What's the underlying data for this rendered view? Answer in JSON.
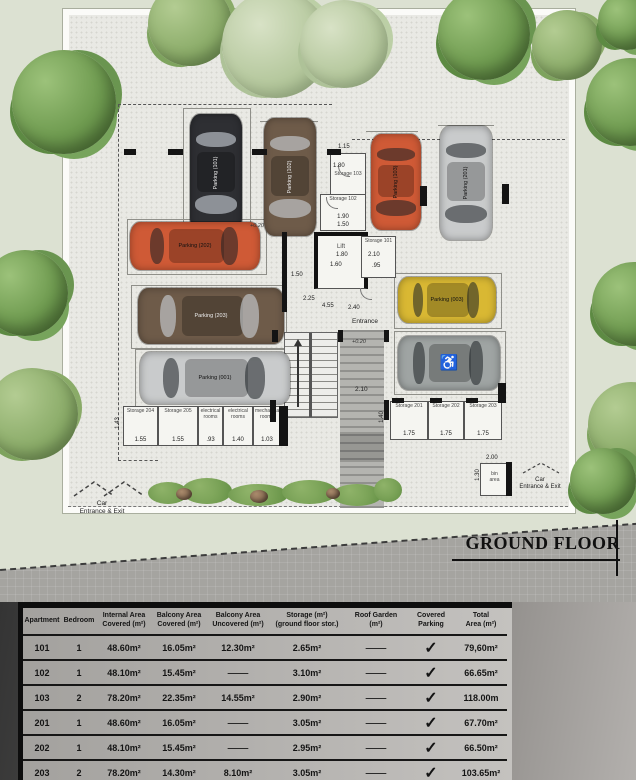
{
  "title": {
    "floor": "GROUND FLOOR"
  },
  "plan": {
    "parkings": [
      {
        "label": "Parking (101)",
        "color": "#2e2f33"
      },
      {
        "label": "Parking (102)",
        "color": "#6e5b49"
      },
      {
        "label": "Parking (103)",
        "color": "#cf5a36"
      },
      {
        "label": "Parking (201)",
        "color": "#c9cbcc"
      },
      {
        "label": "Parking (202)",
        "color": "#cf5a36"
      },
      {
        "label": "Parking (203)",
        "color": "#6e5b49"
      },
      {
        "label": "Parking (001)",
        "color": "#c9cbcc"
      },
      {
        "label": "Parking (003)",
        "color": "#d9b833"
      },
      {
        "label": "",
        "color": "#9fa4a3",
        "icon": "wheelchair"
      }
    ],
    "rooms": {
      "s103": {
        "label": "Storage 103"
      },
      "s102": {
        "label": "Storage 102"
      },
      "s101": {
        "label": "Storage 101"
      },
      "lift": {
        "label": "Lift"
      },
      "entrance": {
        "label": "Entrance"
      },
      "s201": {
        "label": "Storage 201"
      },
      "s202": {
        "label": "Storage 202"
      },
      "s203": {
        "label": "Storage 203"
      },
      "s204": {
        "label": "Storage 204"
      },
      "s205": {
        "label": "Storage 205"
      },
      "elec1": {
        "label": "electrical\nrooms"
      },
      "elec2": {
        "label": "electrical\nrooms"
      },
      "mech": {
        "label": "mechanical\nrooms"
      },
      "bin": {
        "label": "bin\narea"
      }
    },
    "dims": [
      "1.15",
      "1.80",
      "1.90",
      "1.50",
      "1.80",
      "1.60",
      "1.50",
      "2.10",
      ".95",
      "4.55",
      "2.40",
      "2.25",
      "+0.20",
      "+0.20",
      "2.10",
      "1.55",
      "1.55",
      ".93",
      "1.40",
      "1.03",
      "1.43",
      "1.75",
      "1.75",
      "1.75",
      "1.40",
      "2.00",
      "1.30"
    ],
    "entrances": {
      "left": "Car\nEntrance & Exit",
      "right": "Car\nEntrance & Exit"
    }
  },
  "table": {
    "columns": [
      "Apartment",
      "Bedroom",
      "Internal Area\nCovered (m²)",
      "Balcony Area\nCovered (m²)",
      "Balcony Area\nUncovered (m²)",
      "Storage (m²)\n(ground floor stor.)",
      "Roof Garden\n(m²)",
      "Covered\nParking",
      "Total\nArea (m²)"
    ],
    "rows": [
      [
        "101",
        "1",
        "48.60m²",
        "16.05m²",
        "12.30m²",
        "2.65m²",
        "—",
        "✓",
        "79,60m²"
      ],
      [
        "102",
        "1",
        "48.10m²",
        "15.45m²",
        "—",
        "3.10m²",
        "—",
        "✓",
        "66.65m²"
      ],
      [
        "103",
        "2",
        "78.20m²",
        "22.35m²",
        "14.55m²",
        "2.90m²",
        "—",
        "✓",
        "118.00m"
      ],
      [
        "201",
        "1",
        "48.60m²",
        "16.05m²",
        "—",
        "3.05m²",
        "—",
        "✓",
        "67.70m²"
      ],
      [
        "202",
        "1",
        "48.10m²",
        "15.45m²",
        "—",
        "2.95m²",
        "—",
        "✓",
        "66.50m²"
      ],
      [
        "203",
        "2",
        "78.20m²",
        "14.30m²",
        "8.10m²",
        "3.05m²",
        "—",
        "✓",
        "103.65m²"
      ]
    ]
  }
}
